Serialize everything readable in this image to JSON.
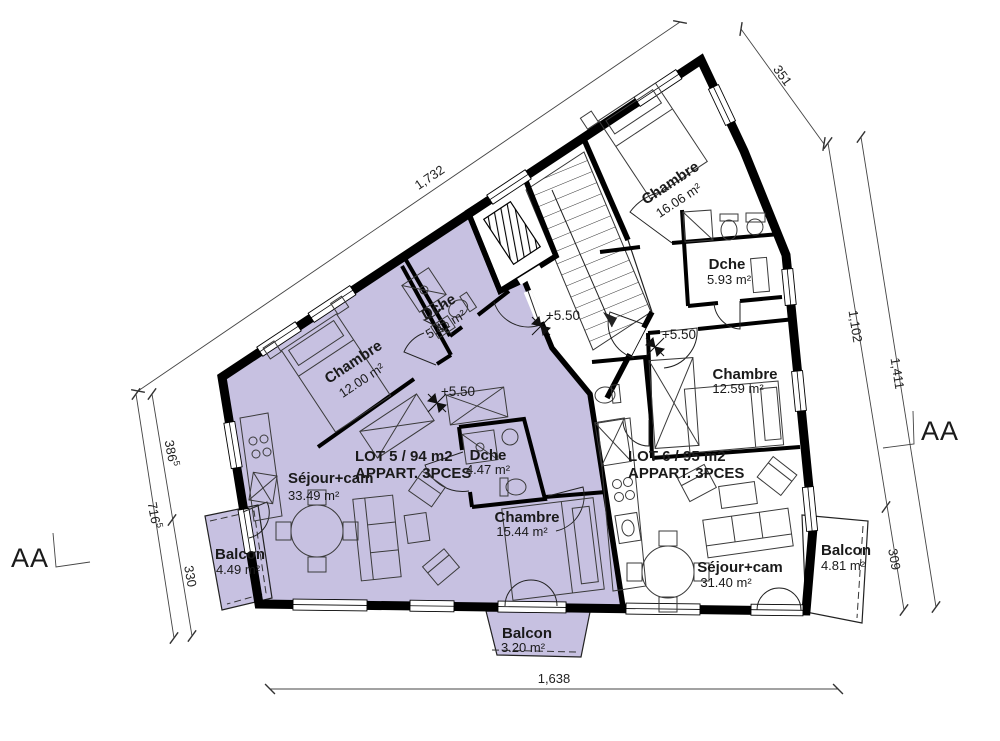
{
  "plan": {
    "level_marker": "+5.50",
    "section_label": "AA",
    "lot5": {
      "name": "LOT 5 / 94 m2",
      "type": "APPART. 3PCES",
      "rooms": {
        "chambre1": {
          "name": "Chambre",
          "area": "12.00 m²"
        },
        "dche1": {
          "name": "Dche",
          "area": "5.41 m²"
        },
        "sejour": {
          "name": "Séjour+cam",
          "area": "33.49 m²"
        },
        "dche2": {
          "name": "Dche",
          "area": "4.47 m²"
        },
        "chambre2": {
          "name": "Chambre",
          "area": "15.44 m²"
        },
        "balcon_west": {
          "name": "Balcon",
          "area": "4.49 m²"
        },
        "balcon_south": {
          "name": "Balcon",
          "area": "3.20 m²"
        }
      }
    },
    "lot6": {
      "name": "LOT 6 / 95 m2",
      "type": "APPART. 3PCES",
      "rooms": {
        "chambre1": {
          "name": "Chambre",
          "area": "16.06 m²"
        },
        "dche": {
          "name": "Dche",
          "area": "5.93 m²"
        },
        "chambre2": {
          "name": "Chambre",
          "area": "12.59 m²"
        },
        "sejour": {
          "name": "Séjour+cam",
          "area": "31.40 m²"
        },
        "balcon": {
          "name": "Balcon",
          "area": "4.81 m²"
        }
      }
    },
    "dimensions": {
      "top": "1,732",
      "top_right": "351",
      "right_inner": "1,102",
      "right_outer": "1,411",
      "right_lower": "309",
      "left_upper_main": "386",
      "left_upper_sup": "5",
      "left_total_main": "716",
      "left_total_sup": "5",
      "left_lower": "330",
      "bottom": "1,638"
    }
  }
}
